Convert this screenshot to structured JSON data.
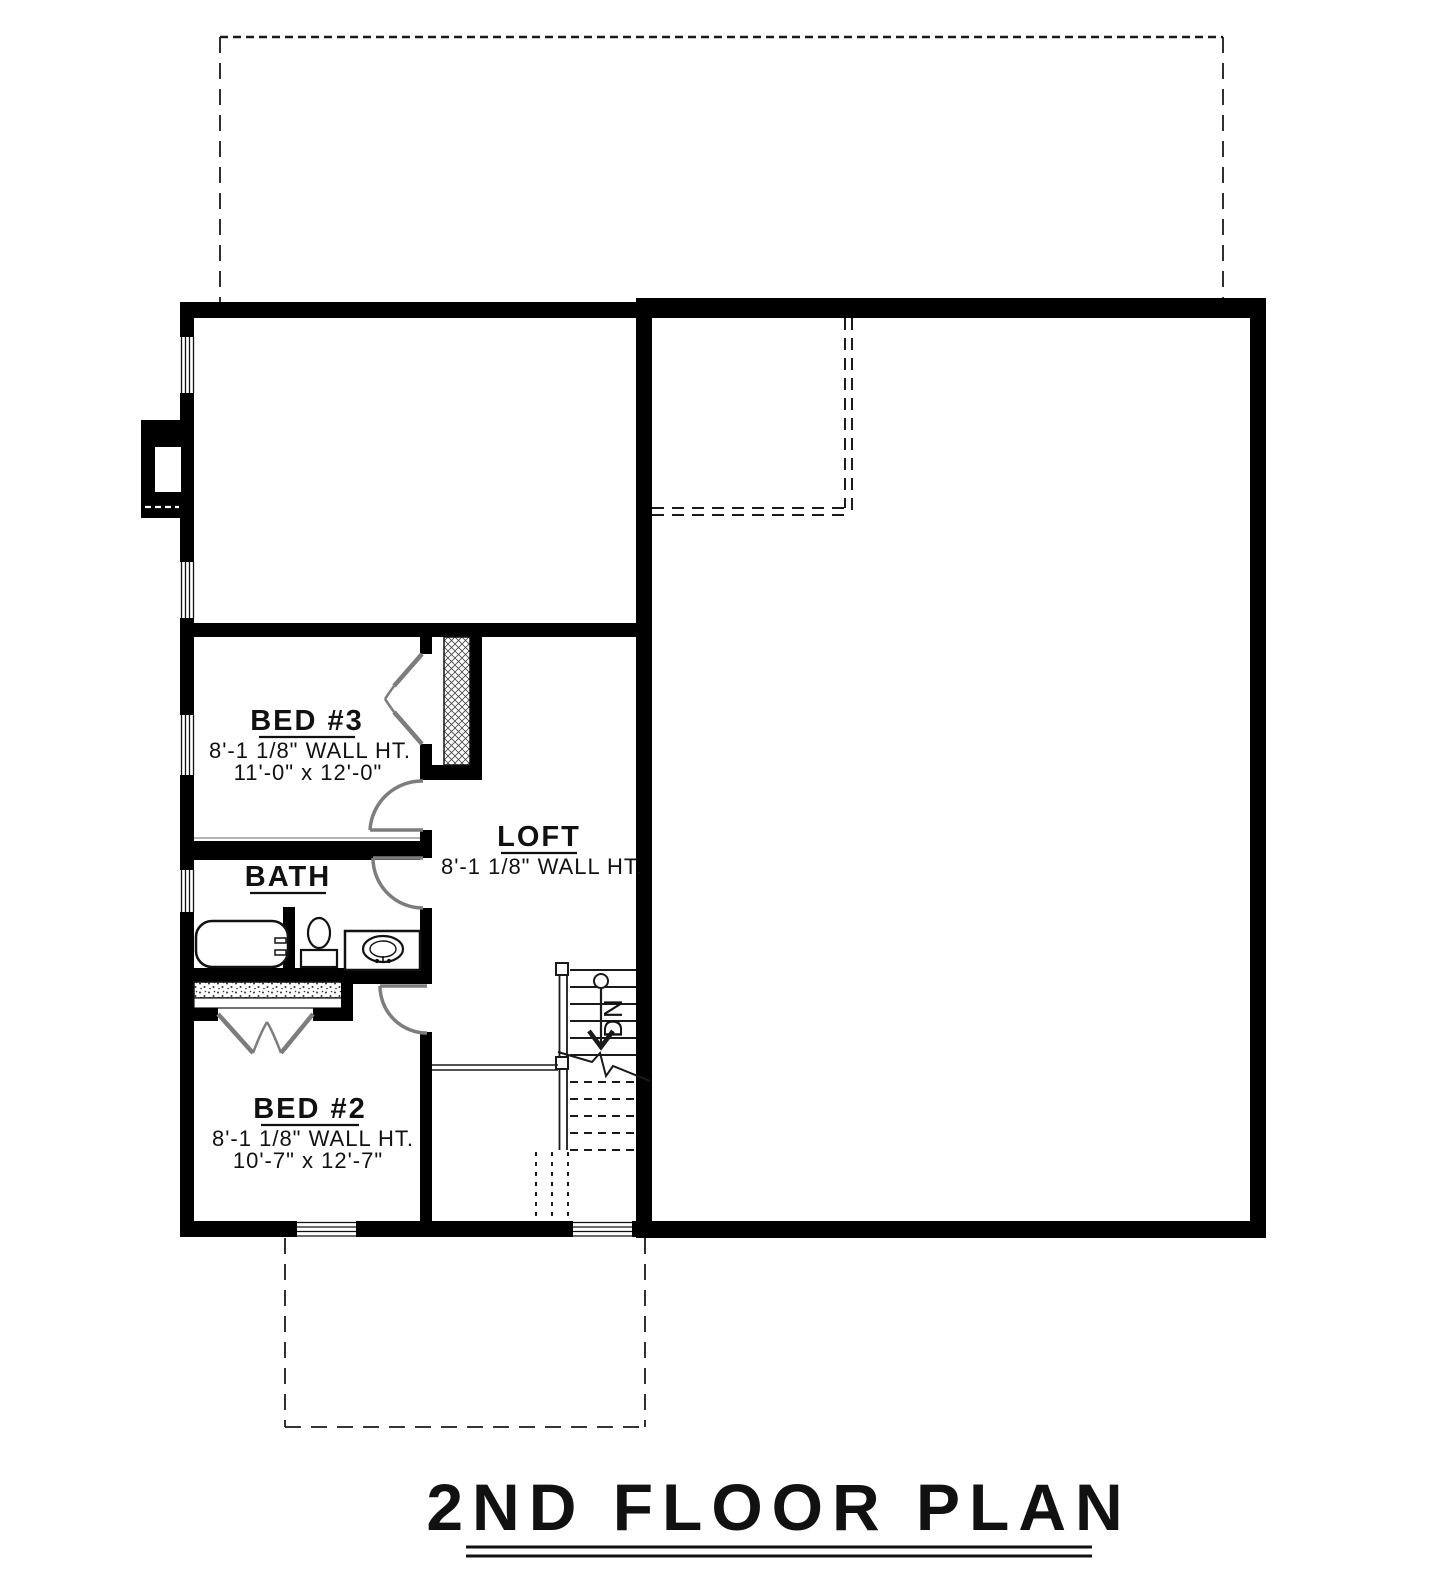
{
  "title": {
    "text": "2ND FLOOR PLAN"
  },
  "rooms": {
    "bed3": {
      "name": "BED #3",
      "wall_height": "8'-1 1/8\" WALL HT.",
      "dimensions": "11'-0\" x 12'-0\""
    },
    "loft": {
      "name": "LOFT",
      "wall_height": "8'-1 1/8\" WALL HT."
    },
    "bath": {
      "name": "BATH"
    },
    "bed2": {
      "name": "BED #2",
      "wall_height": "8'-1 1/8\" WALL HT.",
      "dimensions": "10'-7\" x 12'-7\""
    }
  },
  "stairs": {
    "direction_label": "DN"
  },
  "colors": {
    "walls": "#000000",
    "background": "#ffffff",
    "door_swings": "#7d7d7d",
    "dashed_outlines": "#1a1a1a"
  }
}
